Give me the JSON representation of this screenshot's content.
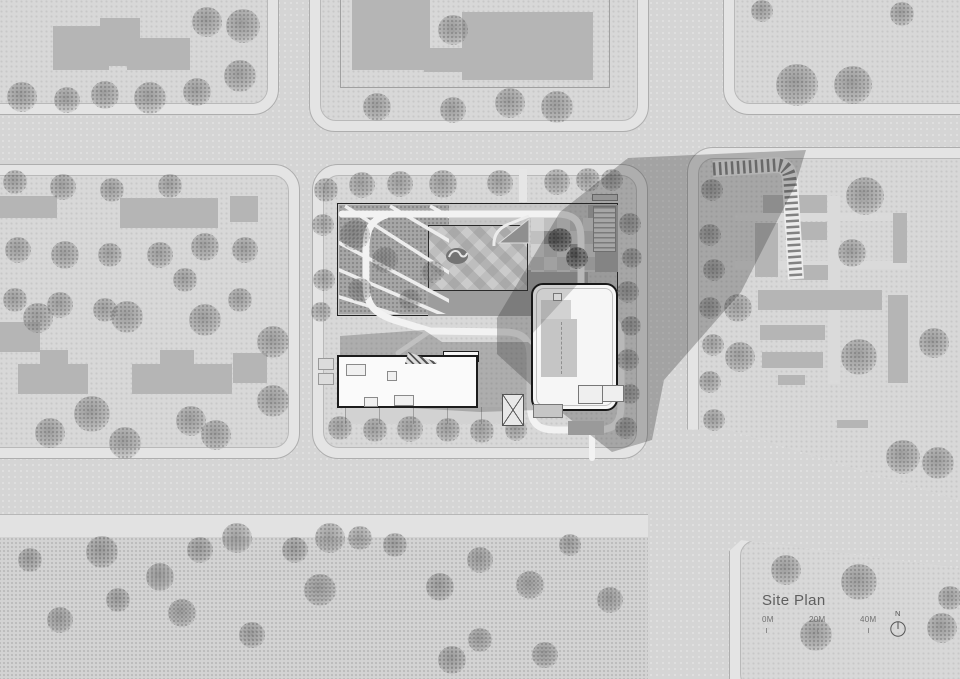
{
  "title": {
    "label": "Site Plan"
  },
  "scalebar": {
    "marks": [
      "0M",
      "20M",
      "40M"
    ]
  },
  "north": {
    "label": "N"
  },
  "palette": {
    "road": "#d5d5d5",
    "sidewalk": "#e4e4e4",
    "block_interior": "#d8d8d8",
    "context_building": "#b5b5b5",
    "site_planting": "#a6a6a6",
    "plaza": "#cccccc",
    "white_building": "#f6f6f6",
    "outline": "#1c1c1c",
    "shadow": "rgba(50,50,50,0.30)"
  },
  "map": {
    "trees": [
      [
        22,
        97,
        15
      ],
      [
        67,
        100,
        13
      ],
      [
        105,
        95,
        14
      ],
      [
        150,
        98,
        16
      ],
      [
        197,
        92,
        14
      ],
      [
        240,
        76,
        16
      ],
      [
        207,
        22,
        15
      ],
      [
        243,
        26,
        17
      ],
      [
        453,
        30,
        15
      ],
      [
        377,
        107,
        14
      ],
      [
        453,
        110,
        13
      ],
      [
        510,
        103,
        15
      ],
      [
        557,
        107,
        16
      ],
      [
        797,
        85,
        21
      ],
      [
        853,
        85,
        19
      ],
      [
        762,
        11,
        11
      ],
      [
        902,
        14,
        12
      ],
      [
        15,
        182,
        12
      ],
      [
        63,
        187,
        13
      ],
      [
        112,
        190,
        12
      ],
      [
        170,
        186,
        12
      ],
      [
        205,
        247,
        14
      ],
      [
        245,
        250,
        13
      ],
      [
        18,
        250,
        13
      ],
      [
        65,
        255,
        14
      ],
      [
        110,
        255,
        12
      ],
      [
        160,
        255,
        13
      ],
      [
        15,
        300,
        12
      ],
      [
        60,
        305,
        13
      ],
      [
        105,
        310,
        12
      ],
      [
        185,
        280,
        12
      ],
      [
        240,
        300,
        12
      ],
      [
        38,
        318,
        15
      ],
      [
        127,
        317,
        16
      ],
      [
        205,
        320,
        16
      ],
      [
        273,
        342,
        16
      ],
      [
        92,
        414,
        18
      ],
      [
        50,
        433,
        15
      ],
      [
        125,
        443,
        16
      ],
      [
        191,
        421,
        15
      ],
      [
        216,
        435,
        15
      ],
      [
        273,
        401,
        16
      ],
      [
        326,
        190,
        12
      ],
      [
        323,
        225,
        11
      ],
      [
        324,
        280,
        11
      ],
      [
        321,
        312,
        10
      ],
      [
        362,
        185,
        13
      ],
      [
        400,
        184,
        13
      ],
      [
        443,
        184,
        14
      ],
      [
        500,
        183,
        13
      ],
      [
        557,
        182,
        13
      ],
      [
        588,
        180,
        12
      ],
      [
        612,
        180,
        11
      ],
      [
        340,
        428,
        12
      ],
      [
        375,
        430,
        12
      ],
      [
        410,
        429,
        13
      ],
      [
        448,
        430,
        12
      ],
      [
        482,
        431,
        12
      ],
      [
        516,
        430,
        11
      ],
      [
        355,
        235,
        15
      ],
      [
        385,
        260,
        13
      ],
      [
        360,
        290,
        12
      ],
      [
        410,
        300,
        11
      ],
      [
        433,
        272,
        11
      ],
      [
        560,
        240,
        12,
        1
      ],
      [
        577,
        258,
        11,
        1
      ],
      [
        630,
        224,
        11
      ],
      [
        632,
        258,
        10
      ],
      [
        628,
        292,
        11
      ],
      [
        631,
        326,
        10
      ],
      [
        628,
        360,
        11
      ],
      [
        630,
        394,
        10
      ],
      [
        626,
        428,
        11
      ],
      [
        712,
        190,
        11
      ],
      [
        710,
        235,
        11
      ],
      [
        714,
        270,
        11
      ],
      [
        710,
        308,
        11
      ],
      [
        713,
        345,
        11
      ],
      [
        710,
        382,
        11
      ],
      [
        714,
        420,
        11
      ],
      [
        865,
        196,
        19
      ],
      [
        852,
        253,
        14
      ],
      [
        859,
        357,
        18
      ],
      [
        934,
        343,
        15
      ],
      [
        738,
        308,
        14
      ],
      [
        740,
        357,
        15
      ],
      [
        903,
        457,
        17
      ],
      [
        938,
        463,
        16
      ],
      [
        102,
        552,
        16
      ],
      [
        160,
        577,
        14
      ],
      [
        118,
        600,
        12
      ],
      [
        182,
        613,
        14
      ],
      [
        200,
        550,
        13
      ],
      [
        237,
        538,
        15
      ],
      [
        295,
        550,
        13
      ],
      [
        330,
        538,
        15
      ],
      [
        360,
        538,
        12
      ],
      [
        320,
        590,
        16
      ],
      [
        252,
        635,
        13
      ],
      [
        452,
        660,
        14
      ],
      [
        440,
        587,
        14
      ],
      [
        30,
        560,
        12
      ],
      [
        60,
        620,
        13
      ],
      [
        395,
        545,
        12
      ],
      [
        480,
        560,
        13
      ],
      [
        530,
        585,
        14
      ],
      [
        570,
        545,
        11
      ],
      [
        610,
        600,
        13
      ],
      [
        480,
        640,
        12
      ],
      [
        545,
        655,
        13
      ],
      [
        786,
        570,
        15
      ],
      [
        859,
        582,
        18
      ],
      [
        942,
        628,
        15
      ],
      [
        816,
        635,
        16
      ],
      [
        950,
        598,
        12
      ]
    ],
    "context_buildings": [
      [
        53,
        26,
        56,
        44
      ],
      [
        100,
        18,
        40,
        48
      ],
      [
        127,
        38,
        63,
        32
      ],
      [
        352,
        0,
        78,
        70
      ],
      [
        462,
        12,
        131,
        68
      ],
      [
        424,
        48,
        46,
        24
      ],
      [
        0,
        196,
        57,
        22
      ],
      [
        120,
        198,
        98,
        30
      ],
      [
        230,
        196,
        28,
        26
      ],
      [
        0,
        322,
        40,
        30
      ],
      [
        18,
        364,
        70,
        30
      ],
      [
        40,
        350,
        28,
        16
      ],
      [
        132,
        364,
        100,
        30
      ],
      [
        160,
        350,
        34,
        16
      ],
      [
        233,
        353,
        34,
        30
      ],
      [
        763,
        195,
        64,
        18
      ],
      [
        785,
        222,
        42,
        18
      ],
      [
        755,
        223,
        23,
        54
      ],
      [
        790,
        265,
        38,
        15
      ],
      [
        758,
        290,
        124,
        20
      ],
      [
        893,
        213,
        14,
        50
      ],
      [
        888,
        295,
        20,
        88
      ],
      [
        760,
        325,
        65,
        15
      ],
      [
        762,
        352,
        61,
        16
      ],
      [
        778,
        375,
        27,
        10
      ],
      [
        837,
        420,
        31,
        8
      ]
    ]
  }
}
